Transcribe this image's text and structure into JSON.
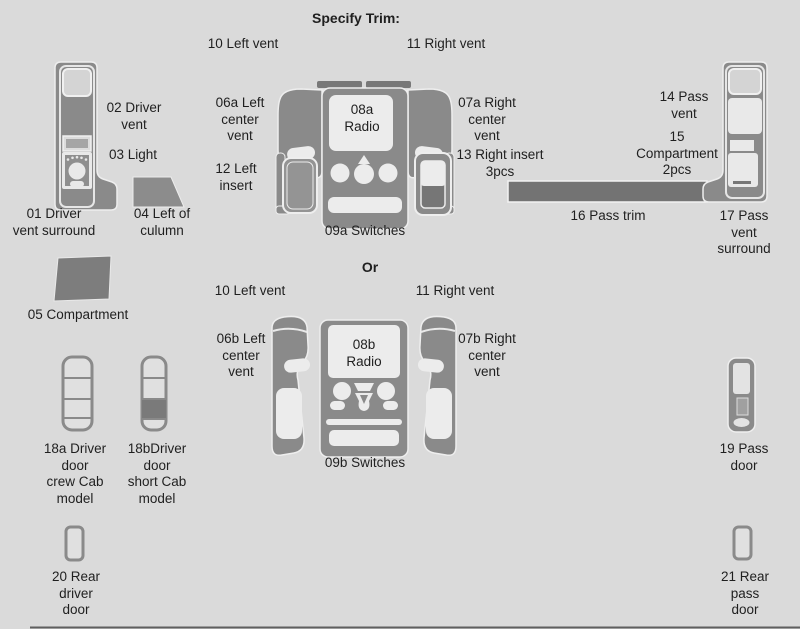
{
  "header": {
    "title": "Specify Trim:"
  },
  "divider": {
    "label": "Or"
  },
  "colors": {
    "background": "#dadada",
    "part_gray": "#8a8a8a",
    "dark_gray": "#737373",
    "cutout_light": "#ececec",
    "text": "#1f1f1f"
  },
  "parts": {
    "p01": {
      "label": "01 Driver\nvent surround"
    },
    "p02": {
      "label": "02 Driver\nvent"
    },
    "p03": {
      "label": "03 Light"
    },
    "p04": {
      "label": "04 Left of\nculumn"
    },
    "p05": {
      "label": "05 Compartment"
    },
    "p06a": {
      "label": "06a Left\ncenter\nvent"
    },
    "p07a": {
      "label": "07a Right\ncenter\nvent"
    },
    "p08a": {
      "label": "08a\nRadio"
    },
    "p09a": {
      "label": "09a Switches"
    },
    "p10_top": {
      "label": "10 Left vent"
    },
    "p11_top": {
      "label": "11 Right vent"
    },
    "p10_mid": {
      "label": "10 Left vent"
    },
    "p11_mid": {
      "label": "11 Right vent"
    },
    "p12": {
      "label": "12 Left\ninsert"
    },
    "p13": {
      "label": "13 Right insert\n3pcs"
    },
    "p14": {
      "label": "14 Pass\nvent"
    },
    "p15": {
      "label": "15\nCompartment\n2pcs"
    },
    "p16": {
      "label": "16 Pass trim"
    },
    "p17": {
      "label": "17 Pass\nvent surround"
    },
    "p06b": {
      "label": "06b Left\ncenter\nvent"
    },
    "p07b": {
      "label": "07b Right\ncenter\nvent"
    },
    "p08b": {
      "label": "08b\nRadio"
    },
    "p09b": {
      "label": "09b Switches"
    },
    "p18a": {
      "label": "18a Driver\ndoor\ncrew Cab\nmodel"
    },
    "p18b": {
      "label": "18bDriver\ndoor\nshort Cab\nmodel"
    },
    "p19": {
      "label": "19 Pass\ndoor"
    },
    "p20": {
      "label": "20 Rear\ndriver\ndoor"
    },
    "p21": {
      "label": "21 Rear\npass\ndoor"
    }
  }
}
